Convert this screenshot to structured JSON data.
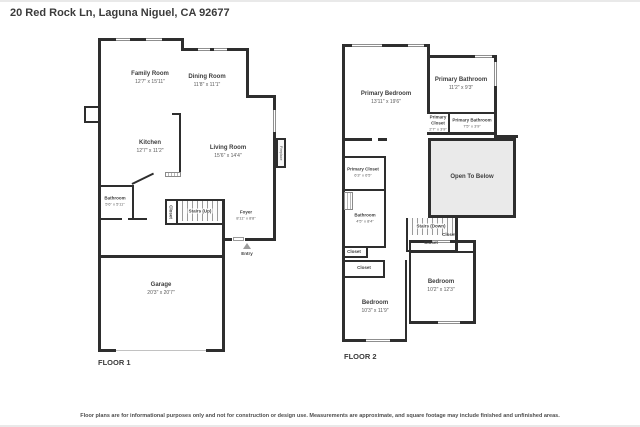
{
  "page": {
    "title": "20 Red Rock Ln, Laguna Niguel, CA 92677",
    "disclaimer": "Floor plans are for informational purposes only and not for construction or design use. Measurements are approximate, and square footage may include finished and unfinished areas."
  },
  "floor1": {
    "label": "FLOOR 1",
    "family_room": {
      "name": "Family Room",
      "dims": "12'7\" x 15'11\""
    },
    "dining_room": {
      "name": "Dining Room",
      "dims": "11'8\" x 11'1\""
    },
    "kitchen": {
      "name": "Kitchen",
      "dims": "12'7\" x 11'2\""
    },
    "living_room": {
      "name": "Living Room",
      "dims": "15'6\" x 14'4\""
    },
    "bathroom": {
      "name": "Bathroom",
      "dims": "5'6\" x 5'11\""
    },
    "closet": {
      "name": "Closet"
    },
    "stairs": {
      "name": "Stairs (Up)"
    },
    "foyer": {
      "name": "Foyer",
      "dims": "8'11\" x 8'8\""
    },
    "entry": {
      "name": "Entry"
    },
    "fireplace": {
      "name": "Fireplace"
    },
    "garage": {
      "name": "Garage",
      "dims": "20'3\" x 20'7\""
    }
  },
  "floor2": {
    "label": "FLOOR 2",
    "primary_bedroom": {
      "name": "Primary Bedroom",
      "dims": "13'11\" x 19'6\""
    },
    "primary_bathroom": {
      "name": "Primary Bathroom",
      "dims": "11'2\" x 9'3\""
    },
    "primary_closet_small": {
      "name": "Primary Closet",
      "dims": "2'7\" x 3'9\""
    },
    "primary_bathroom_small": {
      "name": "Primary Bathroom",
      "dims": "7'5\" x 3'9\""
    },
    "open_to_below": {
      "name": "Open To Below"
    },
    "primary_closet": {
      "name": "Primary Closet",
      "dims": "6'3\" x 6'5\""
    },
    "bathroom": {
      "name": "Bathroom",
      "dims": "4'5\" x 8'4\""
    },
    "stairs": {
      "name": "Stairs (Down)"
    },
    "closet_under_stairs": {
      "name": "Closet"
    },
    "closet_hall_a": {
      "name": "Closet"
    },
    "closet_hall_b": {
      "name": "Closet"
    },
    "closet_bedroom": {
      "name": "Closet"
    },
    "bedroom_left": {
      "name": "Bedroom",
      "dims": "10'3\" x 11'9\""
    },
    "bedroom_right": {
      "name": "Bedroom",
      "dims": "10'2\" x 12'3\""
    }
  }
}
